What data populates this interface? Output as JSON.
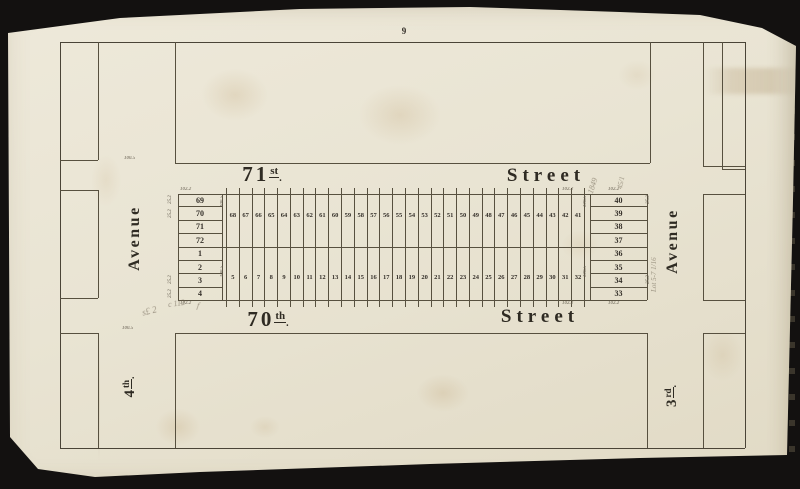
{
  "page_number": "9",
  "streets": {
    "north": {
      "number": "71",
      "ordinal": "st",
      "mark": ".",
      "name": "Street"
    },
    "south": {
      "number": "70",
      "ordinal": "th",
      "mark": ".",
      "name": "Street"
    }
  },
  "avenues": {
    "west": {
      "number": "4",
      "ordinal": "th",
      "mark": ".",
      "name": "Avenue"
    },
    "east": {
      "number": "3",
      "ordinal": "rd",
      "mark": ".",
      "name": "Avenue"
    }
  },
  "block": {
    "west_lots": [
      "69",
      "70",
      "71",
      "72",
      "1",
      "2",
      "3",
      "4"
    ],
    "east_lots": [
      "40",
      "39",
      "38",
      "37",
      "36",
      "35",
      "34",
      "33"
    ],
    "lot_pairs": [
      {
        "t": "68",
        "b": "5"
      },
      {
        "t": "67",
        "b": "6"
      },
      {
        "t": "66",
        "b": "7"
      },
      {
        "t": "65",
        "b": "8"
      },
      {
        "t": "64",
        "b": "9"
      },
      {
        "t": "63",
        "b": "10"
      },
      {
        "t": "62",
        "b": "11"
      },
      {
        "t": "61",
        "b": "12"
      },
      {
        "t": "60",
        "b": "13"
      },
      {
        "t": "59",
        "b": "14"
      },
      {
        "t": "58",
        "b": "15"
      },
      {
        "t": "57",
        "b": "16"
      },
      {
        "t": "56",
        "b": "17"
      },
      {
        "t": "55",
        "b": "18"
      },
      {
        "t": "54",
        "b": "19"
      },
      {
        "t": "53",
        "b": "20"
      },
      {
        "t": "52",
        "b": "21"
      },
      {
        "t": "51",
        "b": "22"
      },
      {
        "t": "50",
        "b": "23"
      },
      {
        "t": "49",
        "b": "24"
      },
      {
        "t": "48",
        "b": "25"
      },
      {
        "t": "47",
        "b": "26"
      },
      {
        "t": "46",
        "b": "27"
      },
      {
        "t": "45",
        "b": "28"
      },
      {
        "t": "44",
        "b": "29"
      },
      {
        "t": "43",
        "b": "30"
      },
      {
        "t": "42",
        "b": "31"
      },
      {
        "t": "41",
        "b": "32"
      }
    ]
  },
  "dimensions": {
    "d1": "102.2",
    "d2": "102.2",
    "d3": "102.2",
    "d4": "102.2",
    "d5": "102.2",
    "d6": "102.2",
    "d7": "100.5",
    "d8": "100.5",
    "d9": "25.2",
    "d10": "25.2",
    "d11": "25.2",
    "d12": "25.2",
    "d13": "25.2",
    "d14": "25.2",
    "d15": "100.5",
    "d16": "100.5",
    "d17": "100.5",
    "d18": "100.5"
  },
  "handwritten": {
    "n1": "1849",
    "n2": "45/1",
    "n3": "Lot 5-7 1/16",
    "n4": "s£ 2",
    "n5": "c 112",
    "n6": "f"
  }
}
